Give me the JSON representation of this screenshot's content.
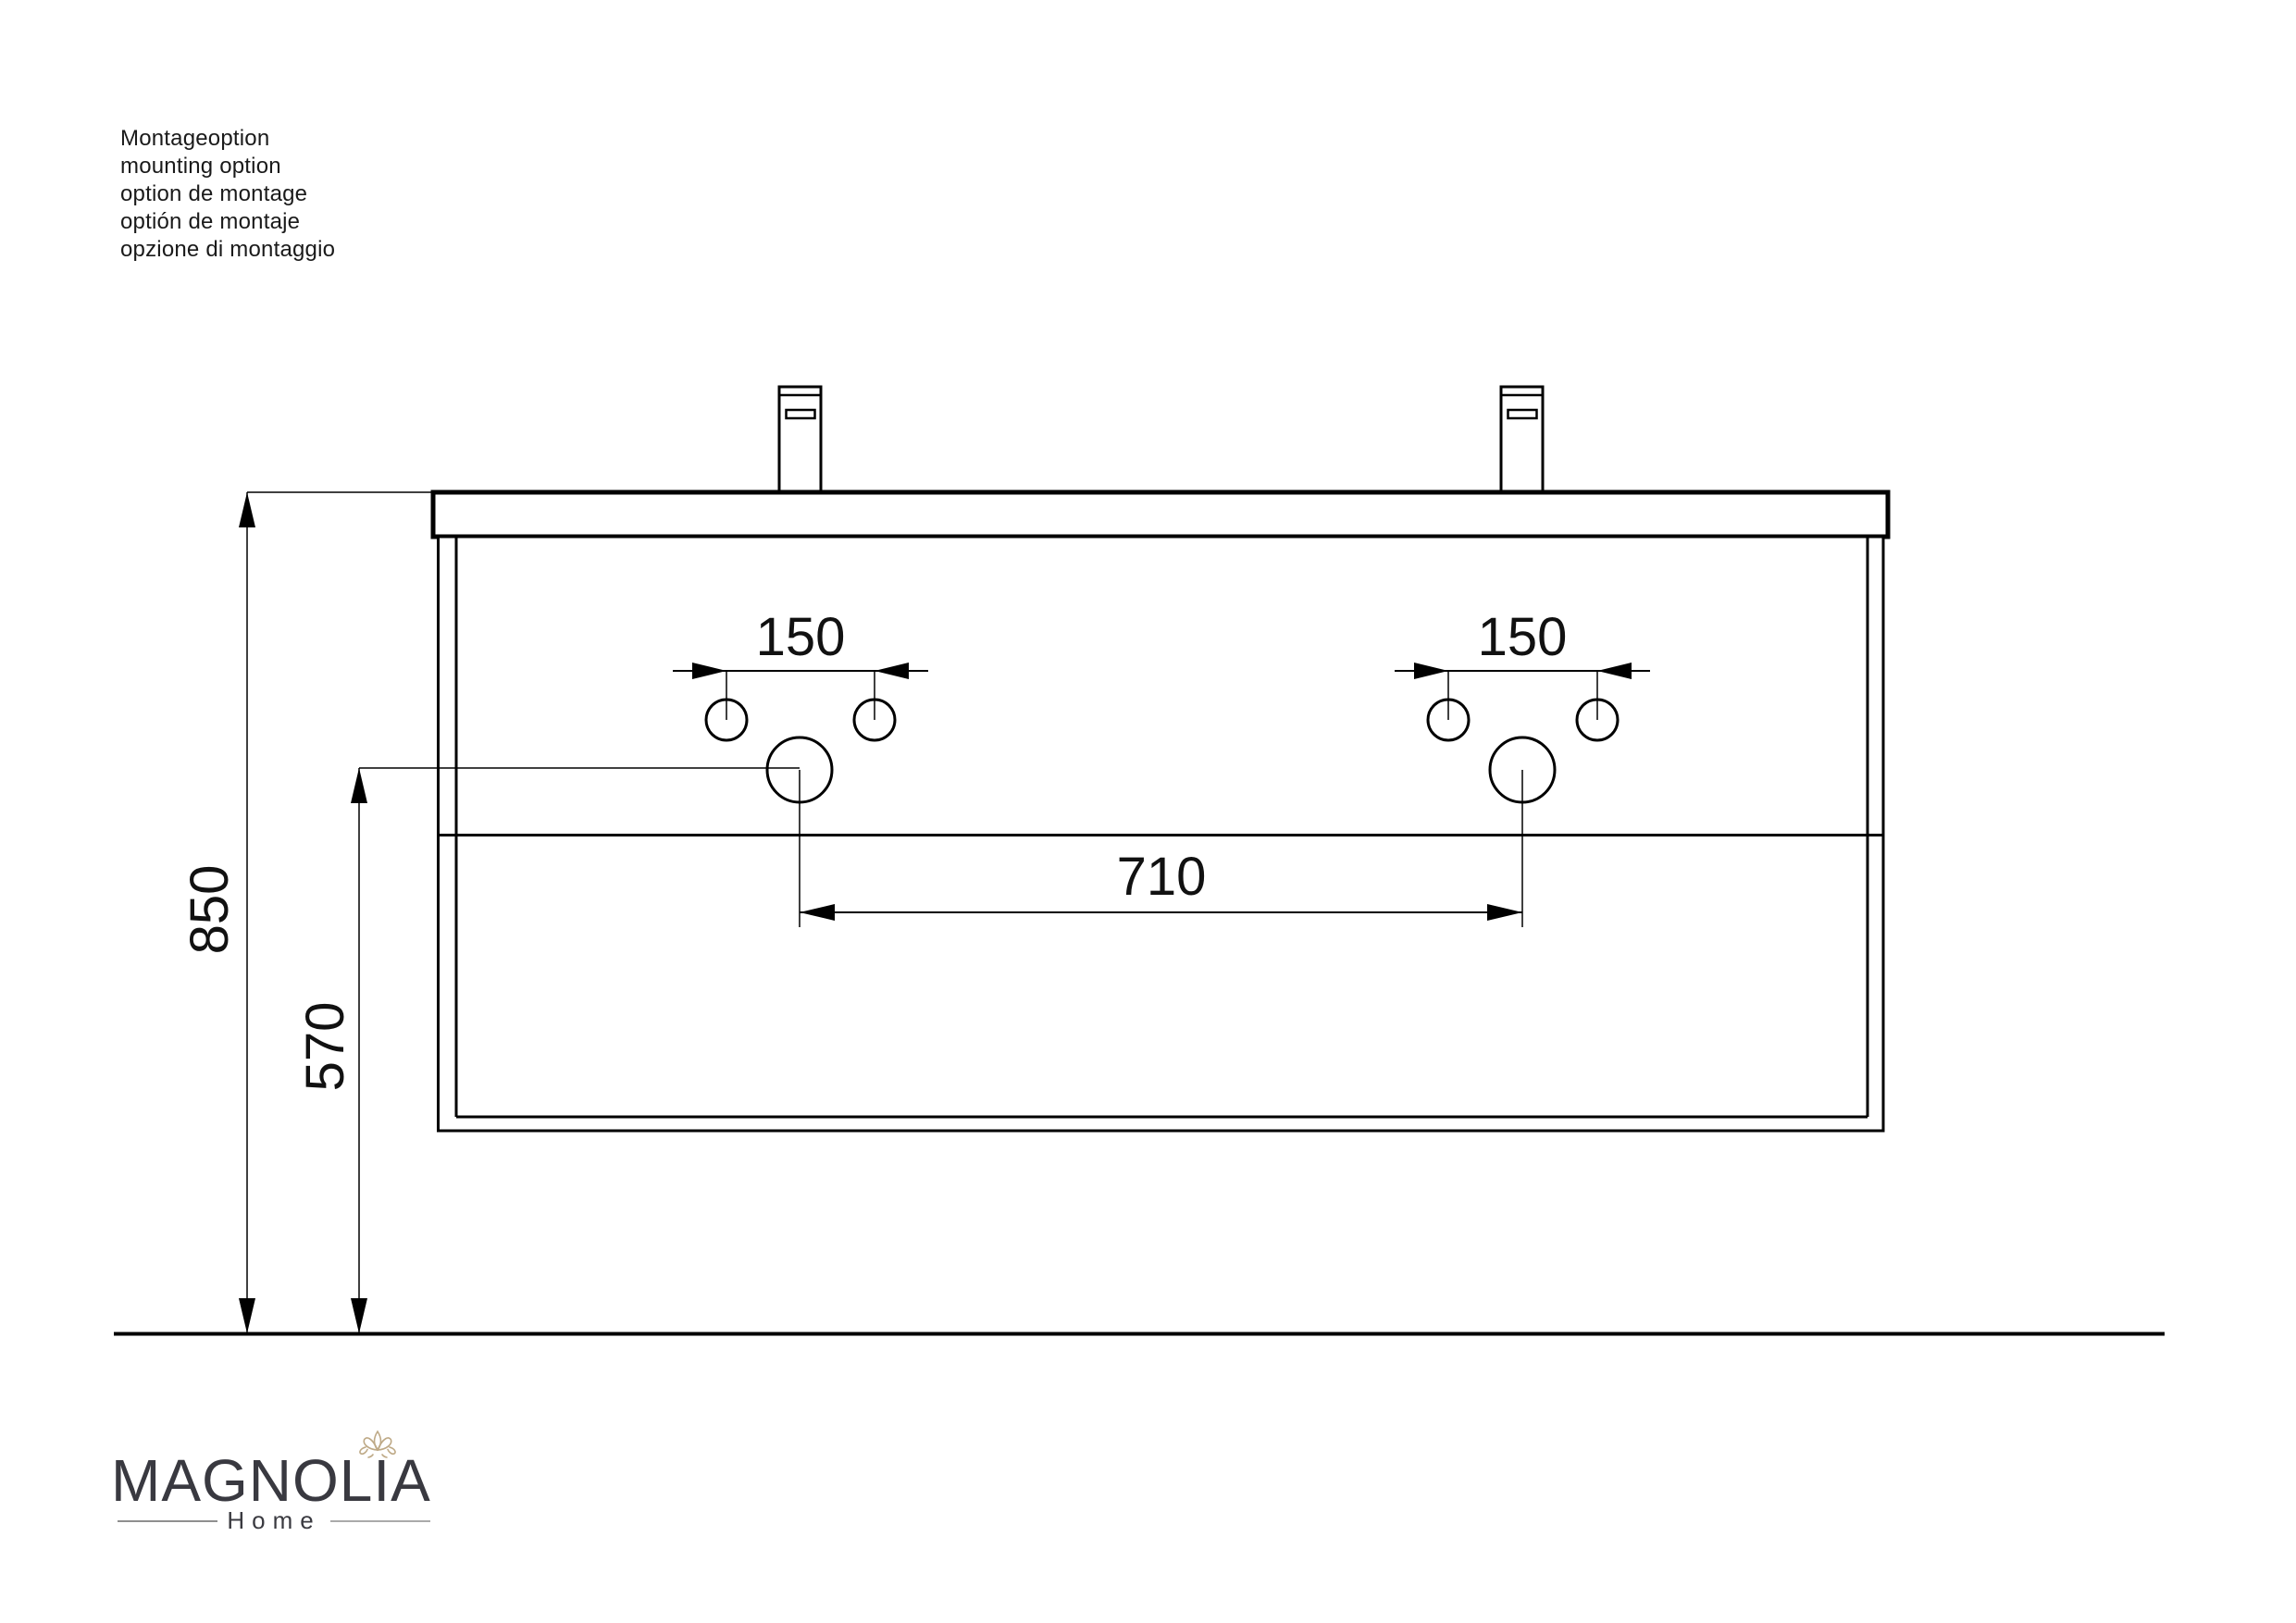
{
  "notes": {
    "lines": [
      "Montageoption",
      "mounting option",
      "option de montage",
      "optión de montaje",
      "opzione di montaggio"
    ]
  },
  "dimensions": {
    "faucet_holes_left": "150",
    "faucet_holes_right": "150",
    "drain_spacing": "710",
    "overall_height": "850",
    "drain_height": "570"
  },
  "logo": {
    "brand": "MAGNOLIA",
    "subtitle": "Home"
  },
  "colors": {
    "drawing_line": "#000000",
    "dimension_text": "#111111",
    "brand_text": "#393940",
    "lotus": "#bea986",
    "rule": "#8f8f8f"
  }
}
